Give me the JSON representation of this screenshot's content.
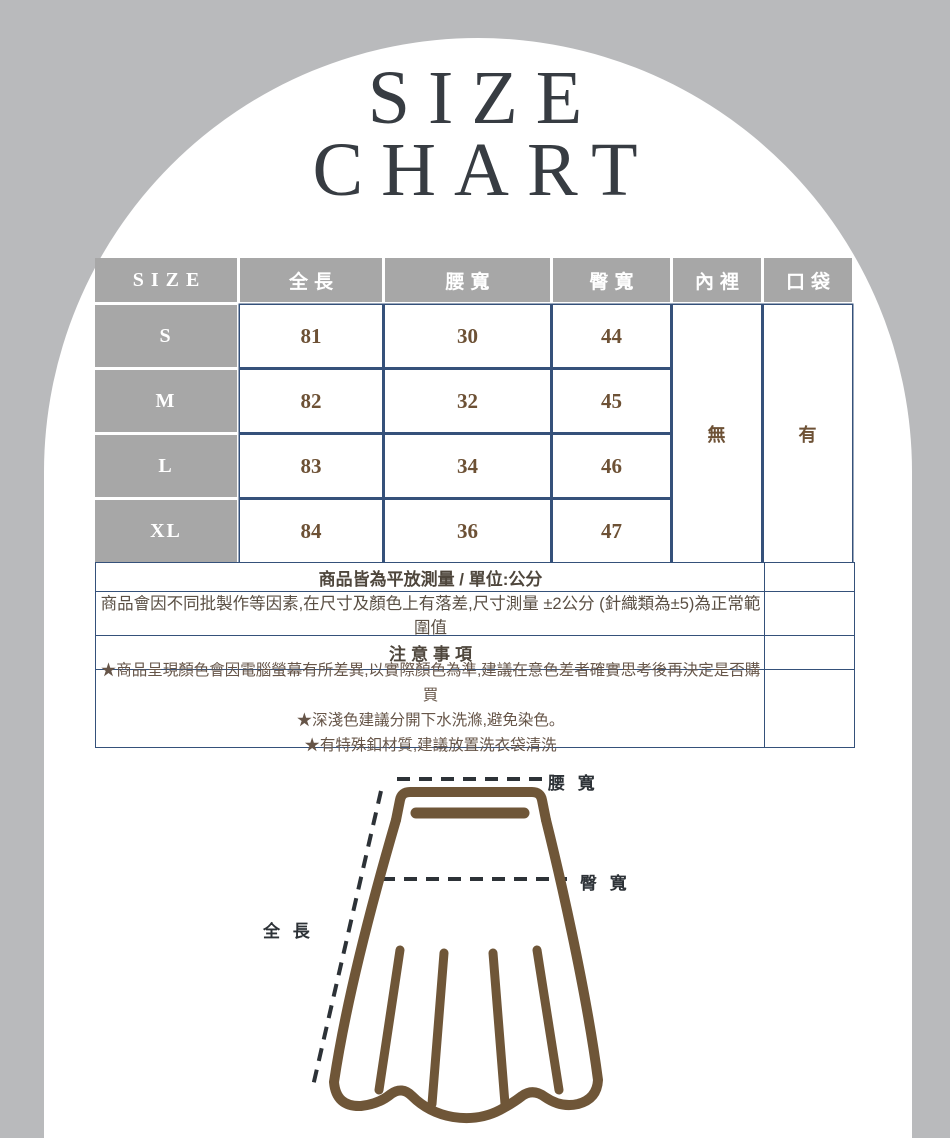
{
  "title": {
    "line1": "SIZE",
    "line2": "CHART"
  },
  "size_table": {
    "columns": [
      "SIZE",
      "全長",
      "腰寬",
      "臀寬",
      "內裡",
      "口袋"
    ],
    "rows": [
      {
        "size": "S",
        "full_length": "81",
        "waist": "30",
        "hip": "44"
      },
      {
        "size": "M",
        "full_length": "82",
        "waist": "32",
        "hip": "45"
      },
      {
        "size": "L",
        "full_length": "83",
        "waist": "34",
        "hip": "46"
      },
      {
        "size": "XL",
        "full_length": "84",
        "waist": "36",
        "hip": "47"
      }
    ],
    "lining_value": "無",
    "pocket_value": "有"
  },
  "notes": {
    "measure_note_prefix": "商品皆為平放測量 / 單位:",
    "measure_note_unit": "公分",
    "tolerance_note": "商品會因不同批製作等因素,在尺寸及顏色上有落差,尺寸測量 ±2公分 (針織類為±5)為正常範圍值",
    "attention_title": "注意事項",
    "attention_items": [
      "★商品呈現顏色會因電腦螢幕有所差異,以實際顏色為準,建議在意色差者確實思考後再決定是否購買",
      "★深淺色建議分開下水洗滌,避免染色。",
      "★有特殊釦材質,建議放置洗衣袋清洗"
    ]
  },
  "diagram": {
    "waist_label": "腰 寬",
    "hip_label": "臀 寬",
    "length_label": "全 長"
  },
  "colors": {
    "page_background": "#b9babc",
    "arch_background": "#ffffff",
    "header_gray": "#a7a7a7",
    "table_border_navy": "#35517a",
    "value_brown": "#6d5135",
    "skirt_brown": "#6f5638",
    "label_dark": "#2d3237"
  }
}
